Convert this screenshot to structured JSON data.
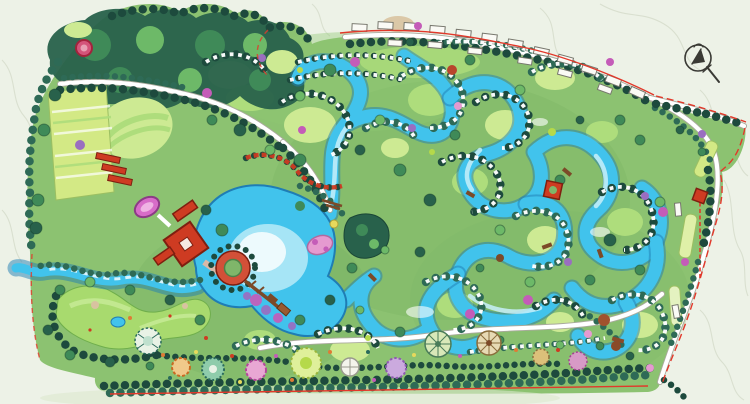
{
  "palette": {
    "bg": "#edf2e7",
    "contour": "#d7decd",
    "site": "#8cc271",
    "forestDark": "#28614b",
    "forestMid": "#3f8a58",
    "canopyLight": "#6db968",
    "lawn": "#cdea93",
    "lawnMid": "#aedd7c",
    "field": "#d3e985",
    "golf": "#a8da6e",
    "water": "#41c3ec",
    "waterDeep": "#1f7db4",
    "waterLight": "#c8f0fa",
    "treeDark": "#1d4a3d",
    "treeMid": "#2e6a56",
    "road": "#ffffff",
    "roadEdge": "#a9a99c",
    "villaEdge": "#77776d",
    "red": "#ce3b22",
    "redDark": "#7e1f10",
    "boundary": "#e2382a",
    "magenta": "#c45cb8",
    "purple": "#9a6ec0",
    "pink": "#e59ad0",
    "tan": "#d8c3a0",
    "brown": "#7c4a28",
    "orange": "#df7b35",
    "yellow": "#e7d95c",
    "teal": "#2a6b5c"
  },
  "compass": {
    "icon": "north-arrow-icon"
  },
  "features": [
    {
      "name": "main-lake",
      "color": "#41c3ec"
    },
    {
      "name": "water-channels",
      "color": "#41c3ec"
    },
    {
      "name": "golf-course",
      "color": "#a8da6e"
    },
    {
      "name": "clubhouse-axis",
      "color": "#ce3b22"
    },
    {
      "name": "villa-clusters",
      "color": "#ffffff"
    },
    {
      "name": "tree-rows",
      "color": "#1d4a3d"
    },
    {
      "name": "garden-plazas",
      "color": "#c45cb8"
    },
    {
      "name": "site-boundary",
      "color": "#e2382a"
    }
  ]
}
